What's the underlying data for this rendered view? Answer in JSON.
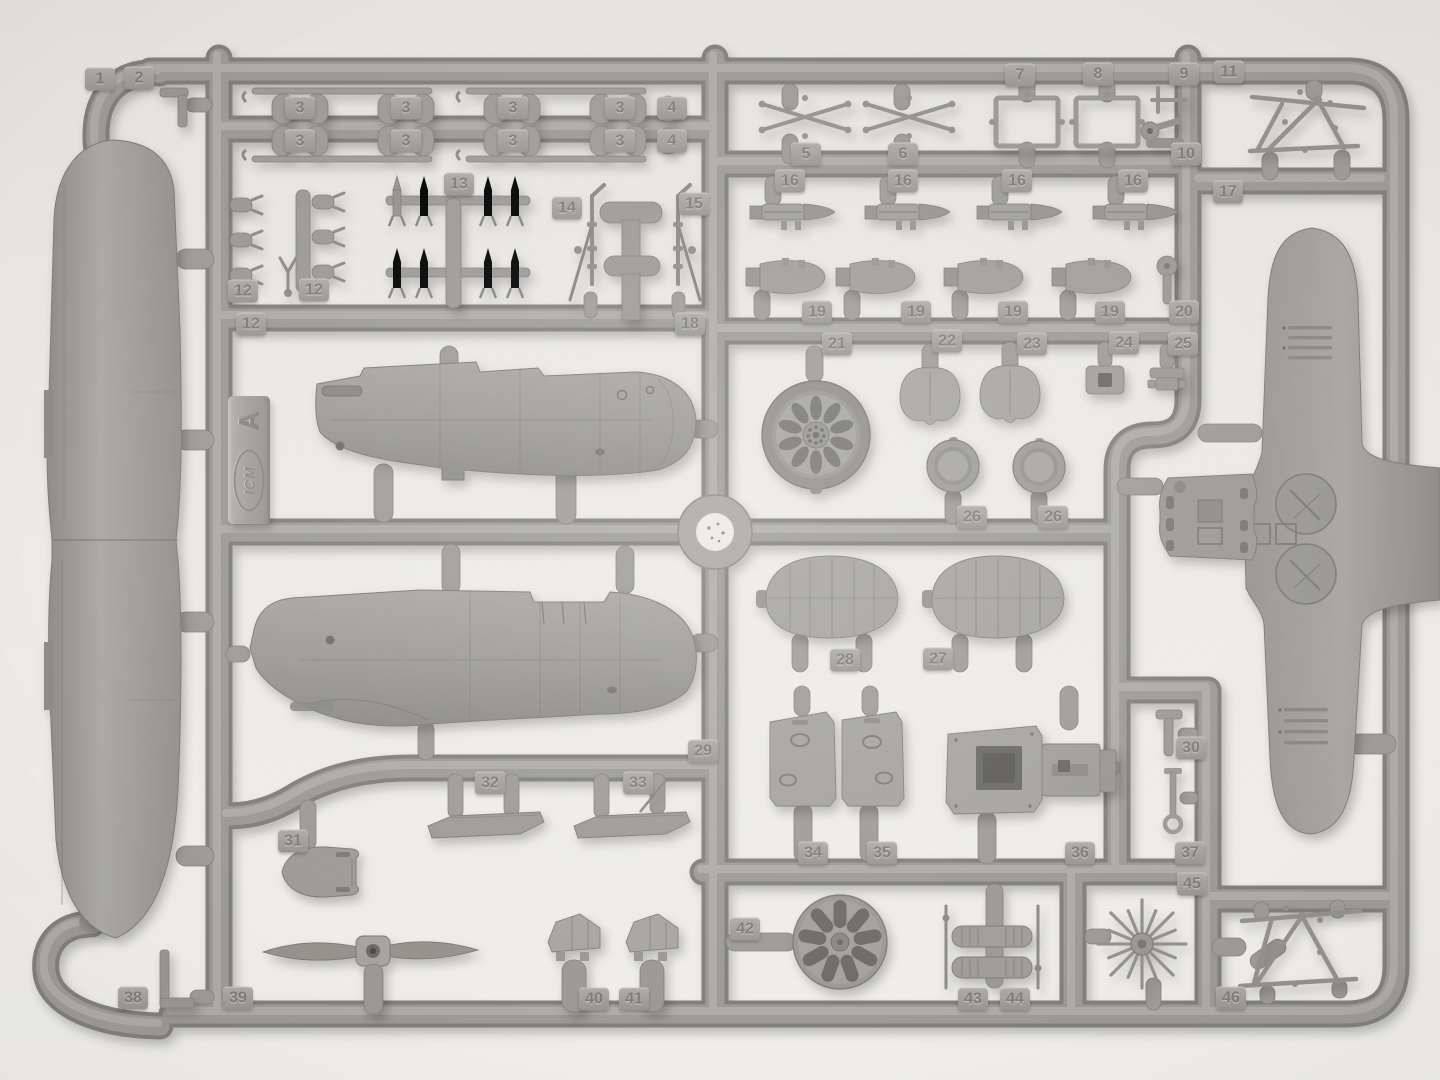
{
  "image": {
    "description": "Photograph of a gray injection-molded plastic model kit sprue (runner frame) of aircraft parts",
    "brand": "ICM",
    "sprue_letter": "A"
  },
  "colors": {
    "background": "#eae8e5",
    "plastic_base": "#a3a19d",
    "plastic_light": "#b5b3af",
    "plastic_dark": "#8a8885",
    "tag_text": "#7e7c79"
  },
  "part_numbers_visible": [
    "1",
    "2",
    "3",
    "4",
    "5",
    "6",
    "7",
    "8",
    "9",
    "10",
    "11",
    "12",
    "13",
    "14",
    "15",
    "16",
    "17",
    "18",
    "19",
    "20",
    "21",
    "22",
    "23",
    "24",
    "25",
    "26",
    "27",
    "28",
    "29",
    "30",
    "31",
    "32",
    "33",
    "34",
    "35",
    "36",
    "37",
    "38",
    "39",
    "40",
    "41",
    "42",
    "43",
    "44",
    "45",
    "46"
  ],
  "part_tags": [
    {
      "label": "1",
      "x": 100,
      "y": 79
    },
    {
      "label": "2",
      "x": 139,
      "y": 78
    },
    {
      "label": "3",
      "x": 300,
      "y": 108
    },
    {
      "label": "3",
      "x": 406,
      "y": 108
    },
    {
      "label": "3",
      "x": 513,
      "y": 108
    },
    {
      "label": "3",
      "x": 620,
      "y": 108
    },
    {
      "label": "4",
      "x": 672,
      "y": 108
    },
    {
      "label": "3",
      "x": 300,
      "y": 141
    },
    {
      "label": "3",
      "x": 406,
      "y": 141
    },
    {
      "label": "3",
      "x": 513,
      "y": 141
    },
    {
      "label": "3",
      "x": 620,
      "y": 141
    },
    {
      "label": "4",
      "x": 672,
      "y": 141
    },
    {
      "label": "5",
      "x": 806,
      "y": 154
    },
    {
      "label": "6",
      "x": 903,
      "y": 154
    },
    {
      "label": "7",
      "x": 1020,
      "y": 75
    },
    {
      "label": "8",
      "x": 1098,
      "y": 74
    },
    {
      "label": "9",
      "x": 1184,
      "y": 74
    },
    {
      "label": "10",
      "x": 1186,
      "y": 154
    },
    {
      "label": "11",
      "x": 1229,
      "y": 72
    },
    {
      "label": "12",
      "x": 243,
      "y": 291
    },
    {
      "label": "12",
      "x": 314,
      "y": 290
    },
    {
      "label": "12",
      "x": 251,
      "y": 324
    },
    {
      "label": "13",
      "x": 459,
      "y": 184
    },
    {
      "label": "14",
      "x": 567,
      "y": 208
    },
    {
      "label": "15",
      "x": 694,
      "y": 204
    },
    {
      "label": "16",
      "x": 790,
      "y": 181
    },
    {
      "label": "16",
      "x": 903,
      "y": 181
    },
    {
      "label": "16",
      "x": 1017,
      "y": 181
    },
    {
      "label": "16",
      "x": 1133,
      "y": 181
    },
    {
      "label": "17",
      "x": 1228,
      "y": 192
    },
    {
      "label": "18",
      "x": 690,
      "y": 324
    },
    {
      "label": "19",
      "x": 817,
      "y": 312
    },
    {
      "label": "19",
      "x": 916,
      "y": 312
    },
    {
      "label": "19",
      "x": 1013,
      "y": 312
    },
    {
      "label": "19",
      "x": 1110,
      "y": 312
    },
    {
      "label": "20",
      "x": 1184,
      "y": 312
    },
    {
      "label": "21",
      "x": 837,
      "y": 344
    },
    {
      "label": "22",
      "x": 947,
      "y": 341
    },
    {
      "label": "23",
      "x": 1032,
      "y": 344
    },
    {
      "label": "24",
      "x": 1124,
      "y": 343
    },
    {
      "label": "25",
      "x": 1183,
      "y": 344
    },
    {
      "label": "26",
      "x": 972,
      "y": 517
    },
    {
      "label": "26",
      "x": 1053,
      "y": 517
    },
    {
      "label": "27",
      "x": 938,
      "y": 659
    },
    {
      "label": "28",
      "x": 845,
      "y": 660
    },
    {
      "label": "29",
      "x": 703,
      "y": 751
    },
    {
      "label": "30",
      "x": 1191,
      "y": 748
    },
    {
      "label": "31",
      "x": 293,
      "y": 841
    },
    {
      "label": "32",
      "x": 490,
      "y": 783
    },
    {
      "label": "33",
      "x": 638,
      "y": 783
    },
    {
      "label": "34",
      "x": 813,
      "y": 853
    },
    {
      "label": "35",
      "x": 882,
      "y": 853
    },
    {
      "label": "36",
      "x": 1080,
      "y": 853
    },
    {
      "label": "37",
      "x": 1190,
      "y": 853
    },
    {
      "label": "38",
      "x": 133,
      "y": 998
    },
    {
      "label": "39",
      "x": 238,
      "y": 998
    },
    {
      "label": "40",
      "x": 594,
      "y": 999
    },
    {
      "label": "41",
      "x": 634,
      "y": 999
    },
    {
      "label": "42",
      "x": 745,
      "y": 929
    },
    {
      "label": "43",
      "x": 973,
      "y": 999
    },
    {
      "label": "44",
      "x": 1015,
      "y": 999
    },
    {
      "label": "45",
      "x": 1192,
      "y": 884
    },
    {
      "label": "46",
      "x": 1231,
      "y": 998
    }
  ]
}
